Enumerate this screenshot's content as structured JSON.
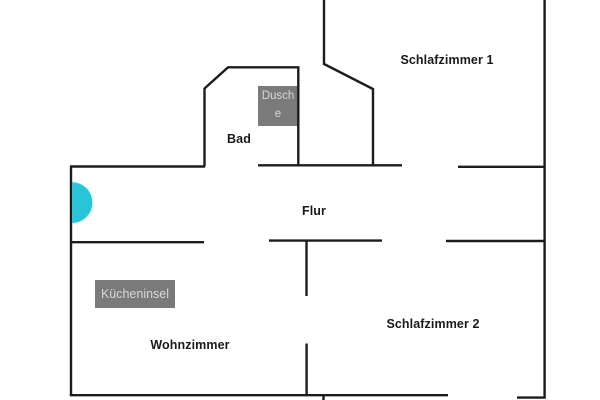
{
  "floorplan": {
    "rooms": {
      "schlafzimmer1": {
        "label": "Schlafzimmer 1"
      },
      "bad": {
        "label": "Bad"
      },
      "flur": {
        "label": "Flur"
      },
      "wohnzimmer": {
        "label": "Wohnzimmer"
      },
      "schlafzimmer2": {
        "label": "Schlafzimmer 2"
      }
    },
    "fixtures": {
      "dusche": {
        "label": "Dusche"
      },
      "kuecheninsel": {
        "label": "Kücheninsel"
      }
    },
    "colors": {
      "wall": "#1c1c1c",
      "door_marker": "#29c4d8",
      "fixture_box_bg": "#7a7a7a",
      "fixture_box_text": "#d8d8d8",
      "room_label": "#1a1a1a",
      "background": "#ffffff"
    }
  }
}
